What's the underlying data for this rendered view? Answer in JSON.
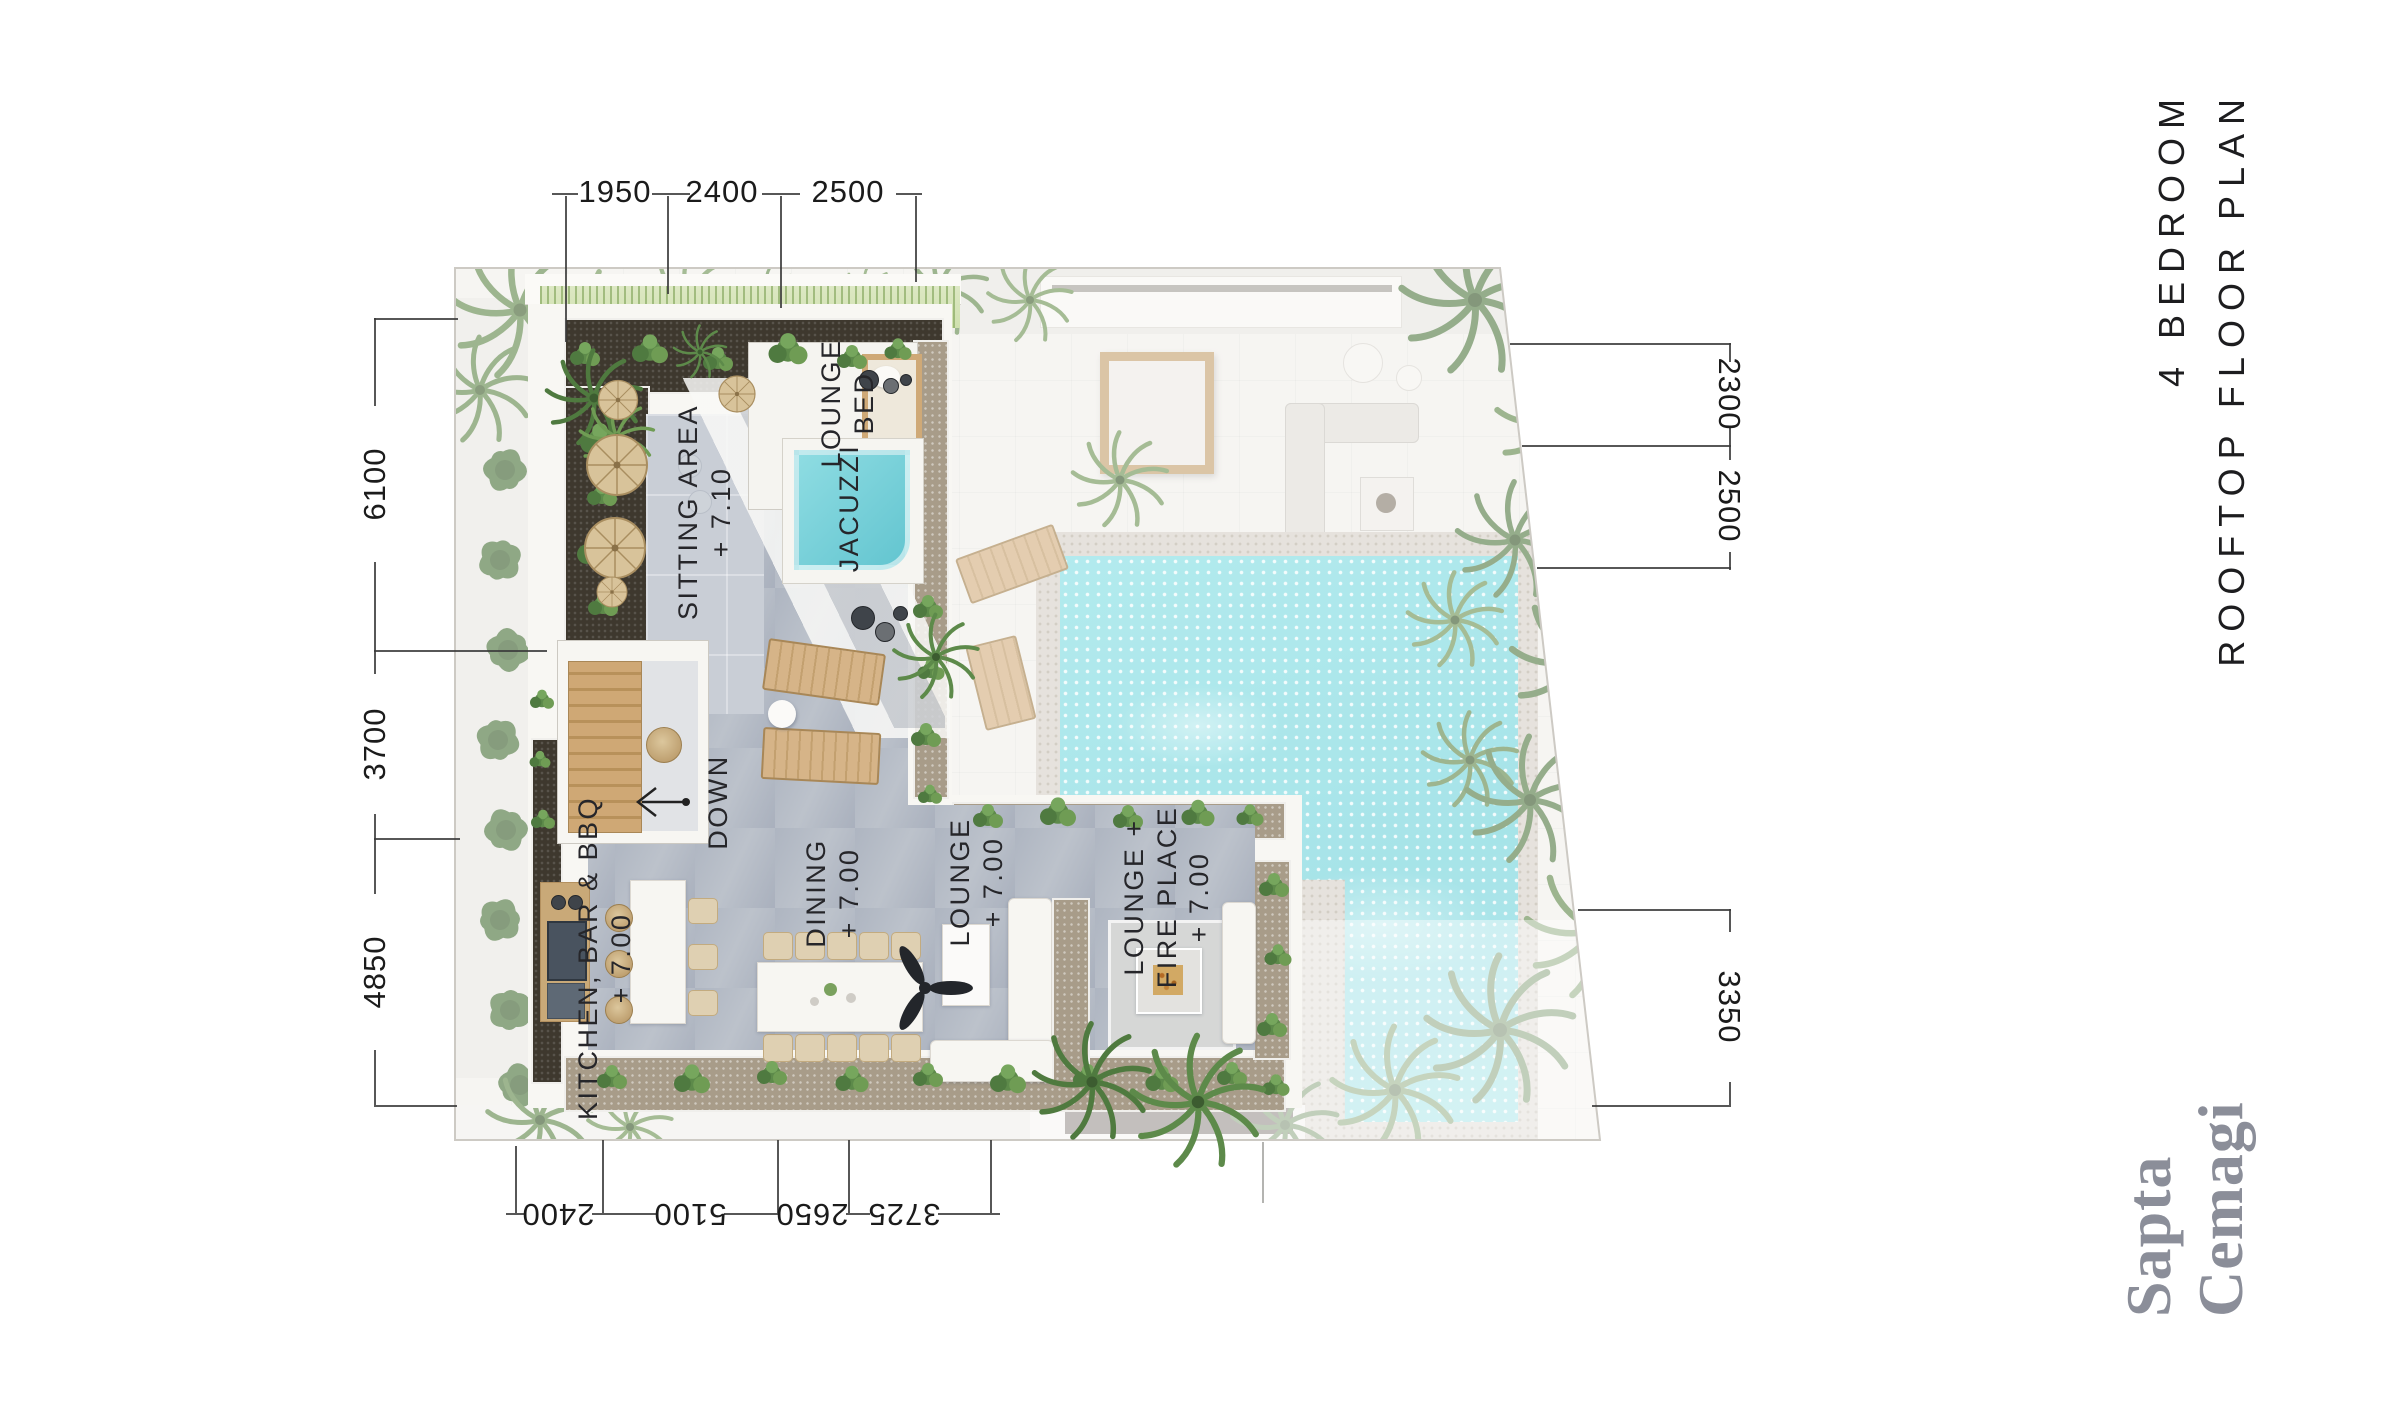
{
  "title": {
    "line1": "4 BEDROOM",
    "line2": "ROOFTOP FLOOR PLAN"
  },
  "logo": {
    "line1": "Sapta",
    "line2": "Cemagi"
  },
  "dims": {
    "top": [
      "1950",
      "2400",
      "2500"
    ],
    "left": [
      "6100",
      "3700",
      "4850"
    ],
    "right": [
      "2300",
      "2500",
      "3350"
    ],
    "bottom": [
      "2400",
      "5100",
      "2650",
      "3725"
    ]
  },
  "rooms": {
    "sitting": {
      "name": "SITTING AREA",
      "level": "+ 7.10"
    },
    "lounge_bed": {
      "line1": "LOUNGE",
      "line2": "BED"
    },
    "jacuzzi": {
      "name": "JACUZZI"
    },
    "down": {
      "name": "DOWN"
    },
    "kitchen": {
      "name": "KITCHEN, BAR & BBQ",
      "level": "+ 7.00"
    },
    "dining": {
      "name": "DINING",
      "level": "+ 7.00"
    },
    "lounge": {
      "name": "LOUNGE",
      "level": "+ 7.00"
    },
    "lounge_fireplace": {
      "line1": "LOUNGE +",
      "line2": "FIRE PLACE",
      "level": "+ 7.00"
    }
  },
  "colors": {
    "pool_water": "#86dde2",
    "jacuzzi_water": "#7fd6de",
    "deck": "#b5bbc5",
    "planter_soil": "#3e382e",
    "pebble": "#a89c89",
    "grass": "#cfe0ae",
    "wood": "#d2b184",
    "logo": "#8b8e99",
    "ink": "#1f1f1f"
  }
}
